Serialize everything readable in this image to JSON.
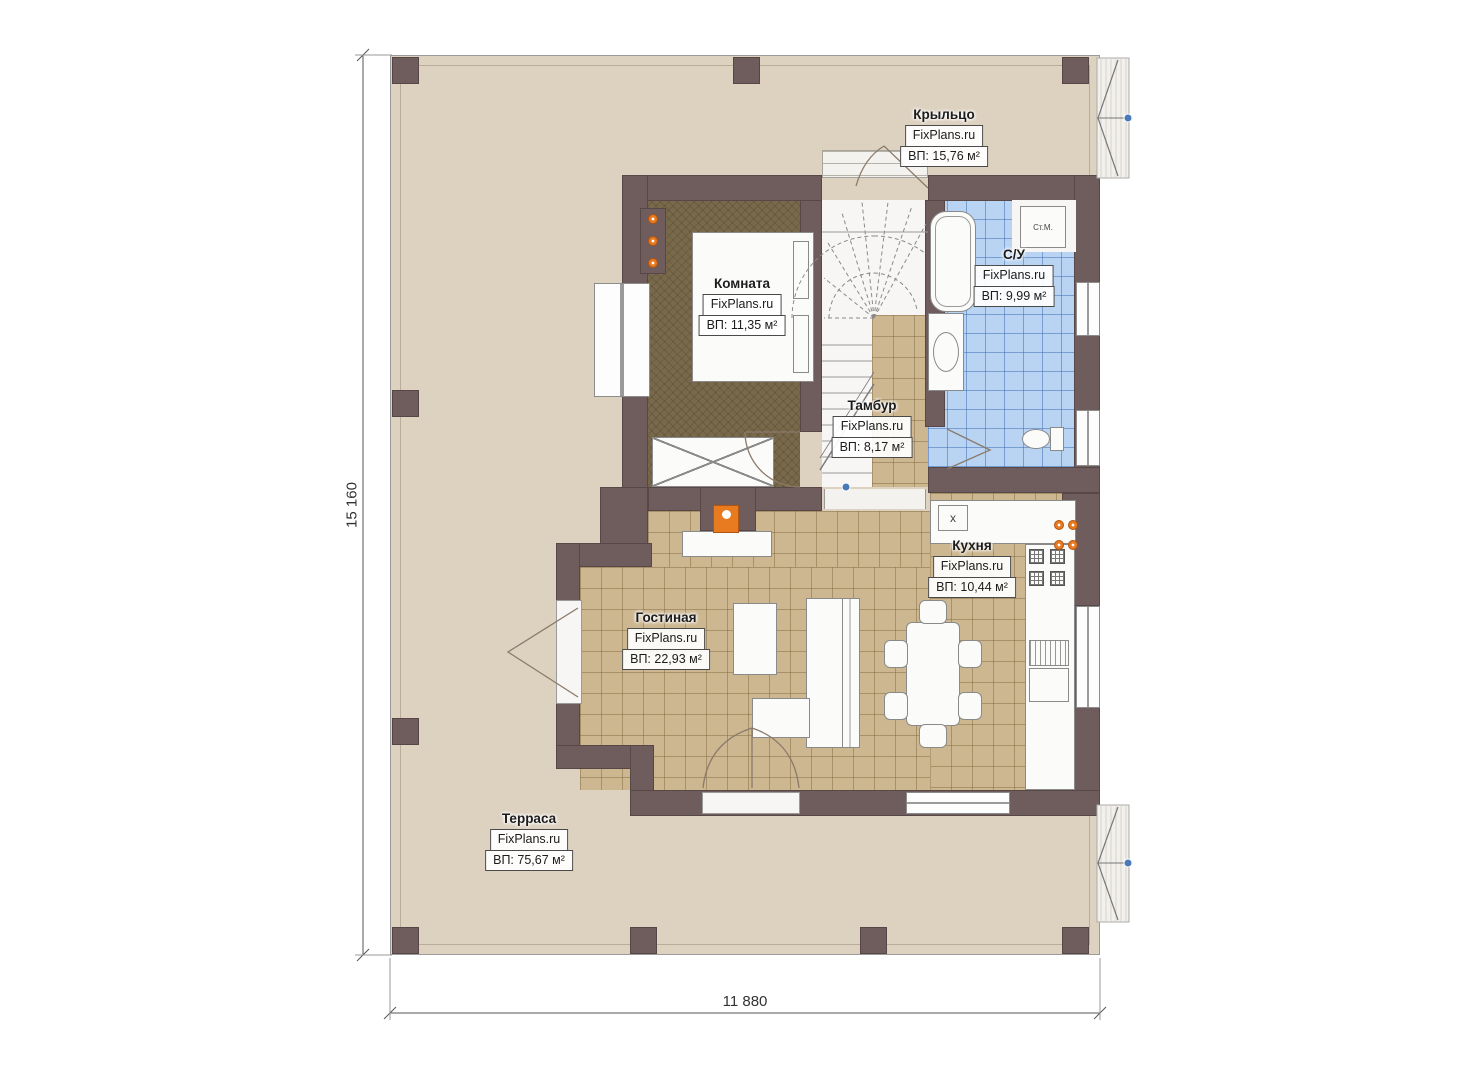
{
  "dimensions": {
    "height_label": "15 160",
    "width_label": "11 880"
  },
  "rooms": {
    "porch": {
      "name": "Крыльцо",
      "brand": "FixPlans.ru",
      "area": "ВП: 15,76 м²"
    },
    "bedroom": {
      "name": "Комната",
      "brand": "FixPlans.ru",
      "area": "ВП: 11,35 м²"
    },
    "bathroom": {
      "name": "С/У",
      "brand": "FixPlans.ru",
      "area": "ВП: 9,99 м²"
    },
    "vestibule": {
      "name": "Тамбур",
      "brand": "FixPlans.ru",
      "area": "ВП: 8,17 м²"
    },
    "kitchen": {
      "name": "Кухня",
      "brand": "FixPlans.ru",
      "area": "ВП: 10,44 м²"
    },
    "living": {
      "name": "Гостиная",
      "brand": "FixPlans.ru",
      "area": "ВП: 22,93 м²"
    },
    "terrace": {
      "name": "Терраса",
      "brand": "FixPlans.ru",
      "area": "ВП: 75,67 м²"
    }
  },
  "fixtures": {
    "washing_machine": "Ст.М.",
    "kitchen_sink_symbol": "x"
  },
  "colors": {
    "wall": "#6f5c5c",
    "terrace_floor": "#ddd1c0",
    "tile_tan": "#cdb791",
    "tile_blue": "#b9d4f2",
    "bedroom_floor": "#79694b",
    "accent_orange": "#e87a20"
  }
}
